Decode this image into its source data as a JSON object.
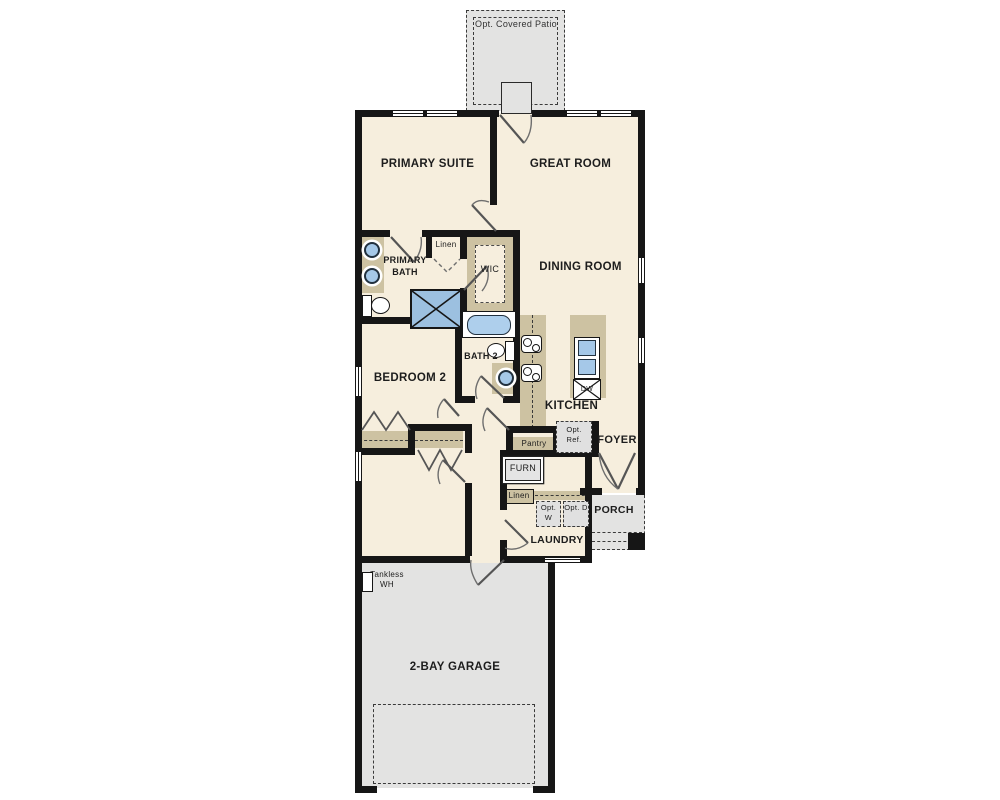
{
  "plan_title": "single-story house floor plan",
  "labels": {
    "patio": "Opt. Covered Patio",
    "primary_suite": "PRIMARY SUITE",
    "great_room": "GREAT ROOM",
    "primary_bath": "PRIMARY BATH",
    "linen_bath": "Linen",
    "wic": "WIC",
    "dining_room": "DINING ROOM",
    "bedroom2": "BEDROOM 2",
    "bath2": "BATH 2",
    "kitchen": "KITCHEN",
    "pantry": "Pantry",
    "opt_ref": "Opt. Ref.",
    "foyer": "FOYER",
    "furn": "FURN",
    "linen_laundry": "Linen",
    "opt_w": "Opt. W",
    "opt_d": "Opt. D",
    "porch": "PORCH",
    "laundry": "LAUNDRY",
    "tankless_wh": "Tankless WH",
    "garage": "2-BAY GARAGE",
    "dw": "DW"
  },
  "colors": {
    "floor": "#f6eedd",
    "hardscape": "#e3e3e2",
    "wall": "#161616",
    "counter_tan": "#cdc2a2",
    "fixture_blue": "#a5c8e8",
    "shower_blue": "#9cc0e0"
  }
}
